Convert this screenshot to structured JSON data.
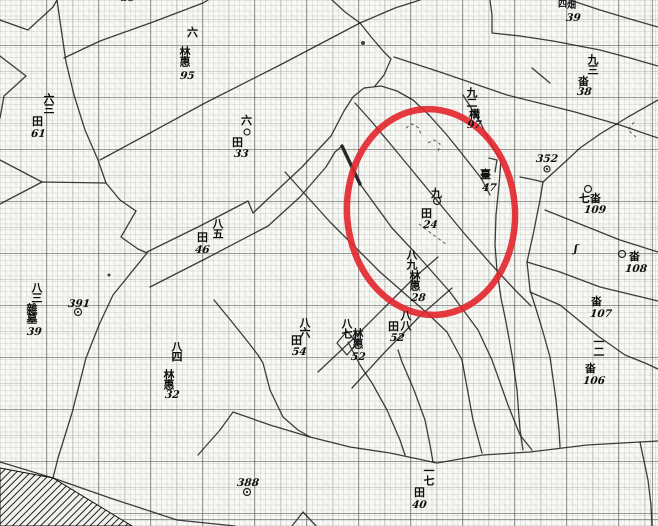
{
  "map": {
    "description_colors": {
      "paper": "#f9f9f6",
      "ink": "#1c1c1c",
      "highlight_red": "#e2252b"
    },
    "highlight_ellipse": {
      "cx": 431,
      "cy": 212,
      "rx": 84,
      "ry": 103,
      "rotate": -4,
      "color": "#e2252b",
      "stroke_width": 6.5,
      "opacity": 0.9
    },
    "hatch_polygon": "0,468 53,478 132,526 0,526",
    "lines": [
      "0,20 28,30 53,7 57,0",
      "0,56 26,76 4,96 0,118",
      "0,160 42,182",
      "0,204 42,182",
      "42,182 106,183",
      "57,0 61,28 66,62 74,95 85,130 98,160 106,183 120,200 136,211",
      "136,211 121,237 138,249 147,253",
      "147,253 113,295 99,325 86,358 72,413 58,458 53,478",
      "0,462 53,478 110,498 177,520 235,526",
      "147,252 200,226 248,201 253,213 270,197 302,167 331,136 344,111 353,97 364,88 381,86 397,91 413,100 429,115",
      "429,115 446,134 459,150 470,164 481,178 490,195",
      "463,95 480,122 493,148 501,160 499,185 496,215 495,245 497,270 501,298 506,322 512,355 517,390 520,430 523,450",
      "355,103 372,122 397,152 430,192 463,232 490,263 515,290 531,306",
      "150,287 205,259 268,226 300,197 326,167 335,152 342,146",
      "360,184 392,228 420,258 450,292 478,330 492,360 508,405 520,435 532,450",
      "100,160 150,133 205,103 280,65 360,23",
      "64,58 100,41 153,22 203,3 208,0",
      "332,0 345,12 360,23",
      "360,23 395,8 420,0",
      "360,23 372,38 384,52 391,59 384,75 375,86",
      "394,57 440,72 507,95 575,112 620,125 658,138",
      "490,0 492,15 492,33 520,36 553,41 600,50 630,58 658,66",
      "570,0 600,10 630,19 658,27",
      "532,68 550,83",
      "543,182 565,162 580,148 600,134 628,117 658,100",
      "520,177 535,180 543,182 540,200 533,235 527,262 530,290 537,312 543,332 550,357 556,400 559,430 560,447",
      "285,172 330,222 380,272 427,313 447,332 462,360 473,420 482,453",
      "318,372 352,340 385,307 415,277 438,257",
      "352,388 385,352 420,316 452,288",
      "214,300 232,322 248,342 258,355 263,363 270,390 283,417 298,430 310,437",
      "348,342 360,365 372,383 387,410 400,440 405,455",
      "398,350 402,362 414,390 425,420 430,445 433,462",
      "198,455 220,430 233,412 270,425 310,437 350,447 390,453 437,463 483,455 530,452 587,445 640,442 658,441",
      "640,442 648,480 651,505 652,526",
      "545,210 580,224 620,240 658,252",
      "527,262 560,272 600,287 658,301",
      "530,292 560,305 598,336 625,355 645,363 658,369",
      "292,526 303,512 316,526",
      "489,158 497,160 495,172",
      "347,331 357,343 347,355 337,343 347,331"
    ],
    "bold_lines": [
      "342,146 360,184"
    ],
    "dashed_marks": [
      "406,128 412,124 419,128 421,135",
      "428,143 434,140 440,144 438,152",
      "419,224 432,234 446,244",
      "634,122 628,130 636,137"
    ],
    "markers": [
      {
        "type": "circle",
        "x": 247,
        "y": 132,
        "r": 3
      },
      {
        "type": "circle",
        "x": 437,
        "y": 201,
        "r": 3.5
      },
      {
        "type": "circle",
        "x": 588,
        "y": 189,
        "r": 3.5
      },
      {
        "type": "circle",
        "x": 622,
        "y": 254,
        "r": 3.5
      },
      {
        "type": "dotcircle",
        "x": 78,
        "y": 312,
        "r": 3.5
      },
      {
        "type": "dotcircle",
        "x": 247,
        "y": 492,
        "r": 3.5
      },
      {
        "type": "dotcircle",
        "x": 547,
        "y": 169,
        "r": 3
      },
      {
        "type": "dot",
        "x": 363,
        "y": 43,
        "r": 2
      },
      {
        "type": "dot",
        "x": 109,
        "y": 275,
        "r": 1.5
      }
    ],
    "labels": [
      {
        "t": "39",
        "k": "n",
        "x": 121,
        "y": -7
      },
      {
        "t": "六",
        "k": "h",
        "x": 187,
        "y": 27
      },
      {
        "t": "林惠",
        "k": "v",
        "x": 179,
        "y": 46
      },
      {
        "t": "95",
        "k": "n",
        "x": 180,
        "y": 71
      },
      {
        "t": "四",
        "k": "h s9",
        "x": 558,
        "y": 1
      },
      {
        "t": "畑",
        "k": "h s9",
        "x": 567,
        "y": 2
      },
      {
        "t": "39",
        "k": "n",
        "x": 566,
        "y": 13
      },
      {
        "t": "九三",
        "k": "v",
        "x": 587,
        "y": 54
      },
      {
        "t": "畓",
        "k": "h",
        "x": 578,
        "y": 76
      },
      {
        "t": "38",
        "k": "n",
        "x": 577,
        "y": 87
      },
      {
        "t": "六三",
        "k": "v",
        "x": 43,
        "y": 93
      },
      {
        "t": "田",
        "k": "h",
        "x": 32,
        "y": 116
      },
      {
        "t": "61",
        "k": "n",
        "x": 31,
        "y": 129
      },
      {
        "t": "六",
        "k": "h",
        "x": 241,
        "y": 115
      },
      {
        "t": "田",
        "k": "h",
        "x": 232,
        "y": 137
      },
      {
        "t": "33",
        "k": "n",
        "x": 234,
        "y": 149
      },
      {
        "t": "九二",
        "k": "v",
        "x": 466,
        "y": 87
      },
      {
        "t": "構",
        "k": "h",
        "x": 469,
        "y": 109
      },
      {
        "t": "97",
        "k": "n",
        "x": 467,
        "y": 120
      },
      {
        "t": "臺",
        "k": "h",
        "x": 480,
        "y": 169
      },
      {
        "t": "47",
        "k": "n",
        "x": 482,
        "y": 183
      },
      {
        "t": "九",
        "k": "h",
        "x": 431,
        "y": 188
      },
      {
        "t": "田",
        "k": "h",
        "x": 421,
        "y": 208
      },
      {
        "t": "24",
        "k": "n",
        "x": 423,
        "y": 220
      },
      {
        "t": "八九",
        "k": "v",
        "x": 406,
        "y": 249
      },
      {
        "t": "林惠",
        "k": "v",
        "x": 409,
        "y": 270
      },
      {
        "t": "28",
        "k": "n",
        "x": 411,
        "y": 293
      },
      {
        "t": "七畓",
        "k": "h",
        "x": 579,
        "y": 193
      },
      {
        "t": "109",
        "k": "n",
        "x": 584,
        "y": 205
      },
      {
        "t": "畓",
        "k": "h",
        "x": 629,
        "y": 251
      },
      {
        "t": "108",
        "k": "n",
        "x": 625,
        "y": 264
      },
      {
        "t": "畓",
        "k": "h",
        "x": 591,
        "y": 296
      },
      {
        "t": "107",
        "k": "n",
        "x": 590,
        "y": 309
      },
      {
        "t": "一二",
        "k": "v",
        "x": 593,
        "y": 336
      },
      {
        "t": "畓",
        "k": "h",
        "x": 585,
        "y": 363
      },
      {
        "t": "106",
        "k": "n",
        "x": 583,
        "y": 376
      },
      {
        "t": "八五",
        "k": "v",
        "x": 212,
        "y": 218
      },
      {
        "t": "田",
        "k": "h",
        "x": 197,
        "y": 232
      },
      {
        "t": "46",
        "k": "n",
        "x": 195,
        "y": 245
      },
      {
        "t": "八三",
        "k": "v",
        "x": 31,
        "y": 282
      },
      {
        "t": "雜墓",
        "k": "v",
        "x": 26,
        "y": 303
      },
      {
        "t": "39",
        "k": "n",
        "x": 27,
        "y": 327
      },
      {
        "t": "391",
        "k": "n",
        "x": 68,
        "y": 299
      },
      {
        "t": "八四",
        "k": "v",
        "x": 171,
        "y": 341
      },
      {
        "t": "林惠",
        "k": "v",
        "x": 163,
        "y": 369
      },
      {
        "t": "32",
        "k": "n",
        "x": 165,
        "y": 390
      },
      {
        "t": "八六",
        "k": "v",
        "x": 299,
        "y": 317
      },
      {
        "t": "田",
        "k": "h",
        "x": 291,
        "y": 335
      },
      {
        "t": "54",
        "k": "n",
        "x": 292,
        "y": 347
      },
      {
        "t": "八七",
        "k": "v",
        "x": 341,
        "y": 318
      },
      {
        "t": "林惠",
        "k": "v",
        "x": 352,
        "y": 328
      },
      {
        "t": "52",
        "k": "n",
        "x": 351,
        "y": 352
      },
      {
        "t": "八八",
        "k": "v",
        "x": 400,
        "y": 310
      },
      {
        "t": "田",
        "k": "h",
        "x": 388,
        "y": 321
      },
      {
        "t": "52",
        "k": "n",
        "x": 390,
        "y": 333
      },
      {
        "t": "388",
        "k": "n",
        "x": 237,
        "y": 478
      },
      {
        "t": "一七",
        "k": "v",
        "x": 423,
        "y": 465
      },
      {
        "t": "田",
        "k": "h",
        "x": 414,
        "y": 487
      },
      {
        "t": "40",
        "k": "n",
        "x": 412,
        "y": 500
      },
      {
        "t": "352",
        "k": "n",
        "x": 536,
        "y": 154
      },
      {
        "t": "ʃ",
        "k": "n",
        "x": 574,
        "y": 244
      }
    ]
  }
}
